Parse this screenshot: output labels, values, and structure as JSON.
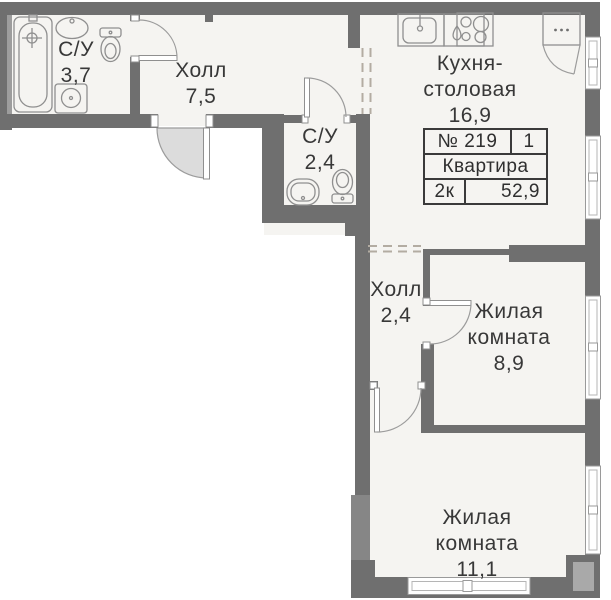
{
  "floor_plan": {
    "apartment": {
      "number_label": "№ 219",
      "section": "1",
      "type_label": "Квартира",
      "rooms_count_label": "2к",
      "total_area": "52,9"
    },
    "rooms": [
      {
        "id": "bathroom-main",
        "lines": [
          "С/У"
        ],
        "area": "3,7"
      },
      {
        "id": "hall-main",
        "lines": [
          "Холл"
        ],
        "area": "7,5"
      },
      {
        "id": "bathroom-guest",
        "lines": [
          "С/У"
        ],
        "area": "2,4"
      },
      {
        "id": "kitchen-dining",
        "lines": [
          "Кухня-",
          "столовая"
        ],
        "area": "16,9"
      },
      {
        "id": "hall-inner",
        "lines": [
          "Холл"
        ],
        "area": "2,4"
      },
      {
        "id": "living-room-1",
        "lines": [
          "Жилая",
          "комната"
        ],
        "area": "8,9"
      },
      {
        "id": "living-room-2",
        "lines": [
          "Жилая",
          "комната"
        ],
        "area": "11,1"
      }
    ],
    "colors": {
      "wall": "#6f6f6f",
      "wall_light": "#a9a9a9",
      "room_fill": "#f5f4f1",
      "fixture_line": "#8f8f8f",
      "door_arc": "#9c9c9c",
      "door_fill": "#dcdcdc",
      "dash_line": "#b3aca2",
      "window_fill": "#ffffff",
      "text": "#383838"
    }
  }
}
